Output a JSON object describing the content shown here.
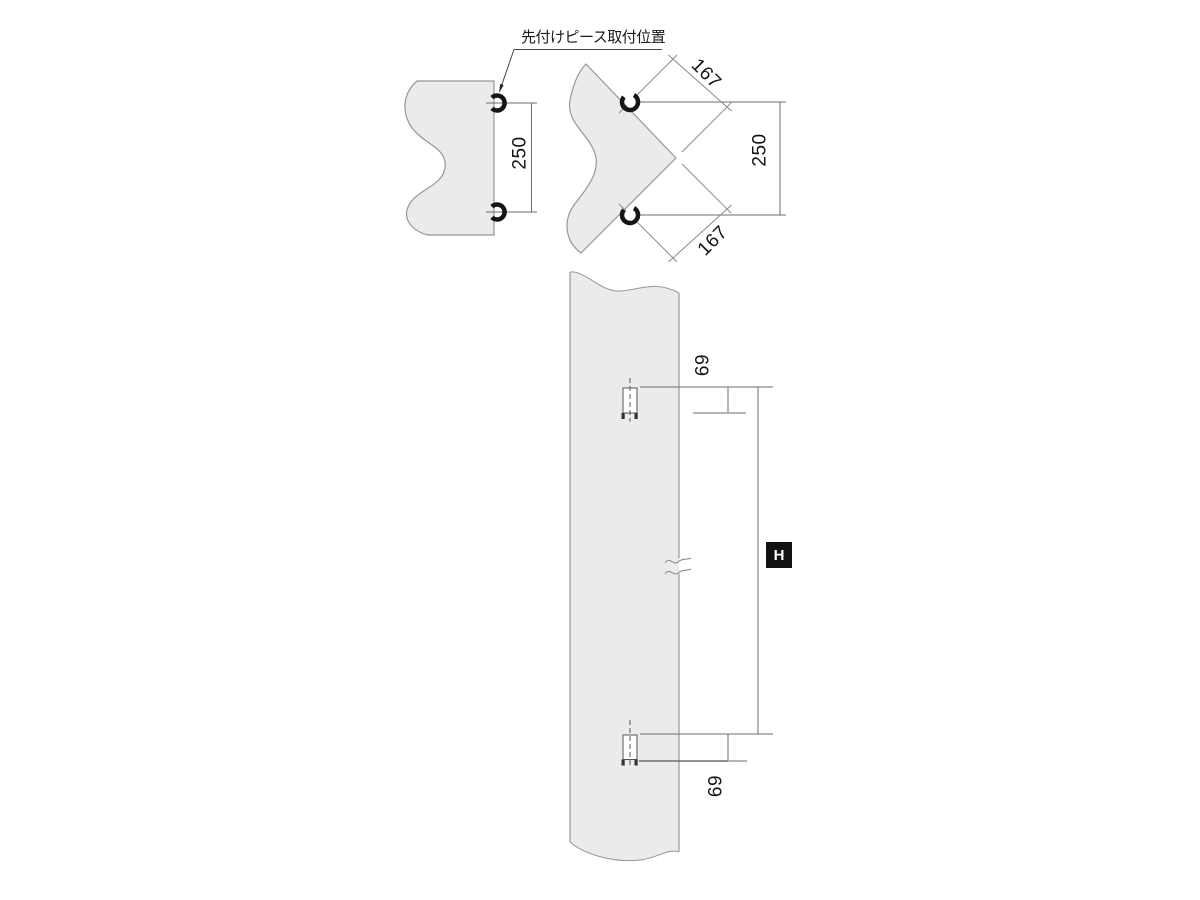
{
  "drawing": {
    "callout_label": "先付けピース取付位置",
    "dims": {
      "side_pitch": "250",
      "corner_pitch": "250",
      "corner_offset_top": "167",
      "corner_offset_bottom": "167",
      "end_offset_top": "69",
      "end_offset_bottom": "69",
      "height_symbol": "H"
    },
    "colors": {
      "panel_fill": "#ebebeb",
      "outline": "#979797",
      "dimension_line": "#6e6e6e",
      "symbol_ink": "#151515",
      "reference_line_light": "#b5b5b5",
      "reference_line_dark": "#6e6e6e",
      "badge_background": "#111111",
      "badge_text": "#ffffff"
    }
  }
}
